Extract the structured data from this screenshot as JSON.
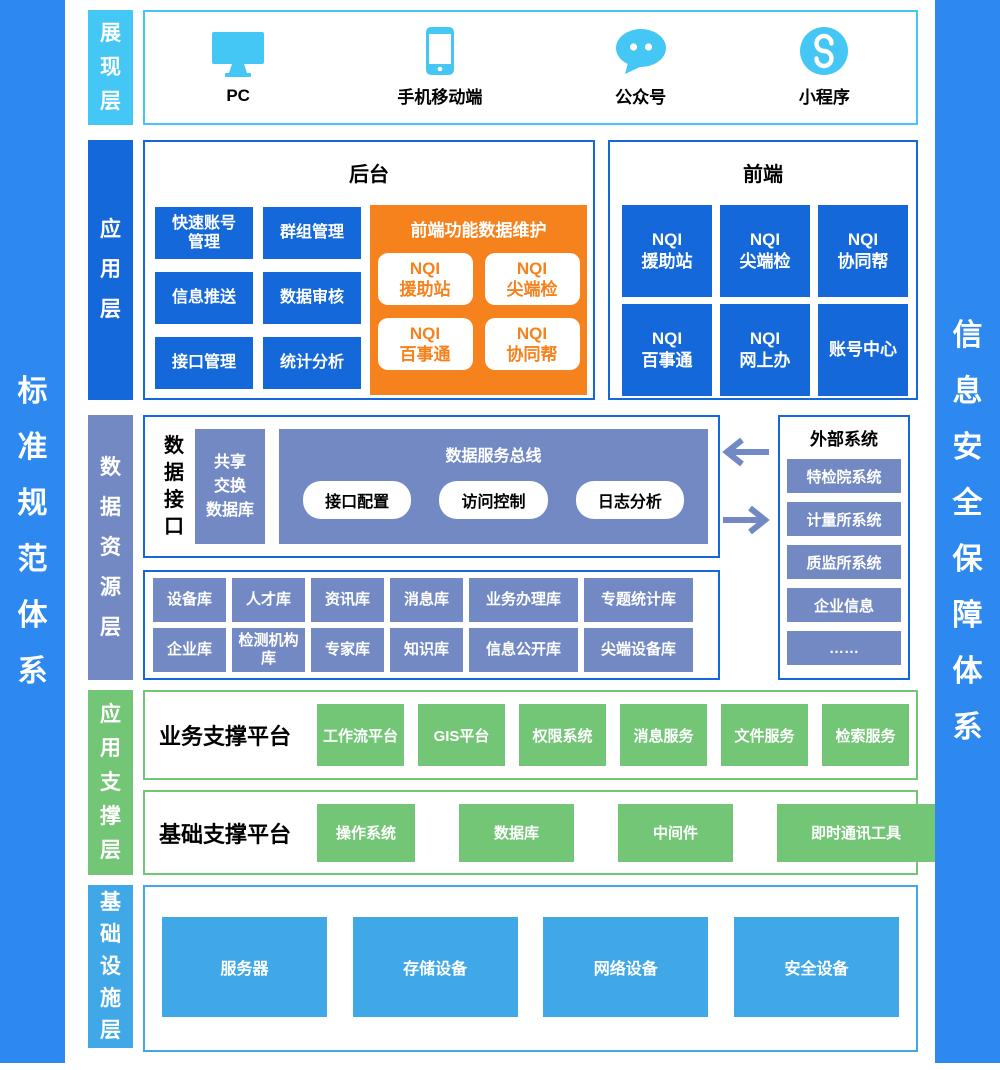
{
  "banners": {
    "left": "标准规范体系",
    "right": "信息安全保障体系"
  },
  "colors": {
    "banner_blue": "#2d89f0",
    "presentation_cyan": "#44c7f4",
    "application_blue": "#1568d9",
    "maintenance_orange": "#f6821e",
    "data_periwinkle": "#7289c4",
    "support_green": "#74c677",
    "infrastructure_blue": "#41a8e8"
  },
  "presentation": {
    "label": "展现层",
    "items": [
      {
        "label": "PC",
        "icon": "monitor-icon"
      },
      {
        "label": "手机移动端",
        "icon": "smartphone-icon"
      },
      {
        "label": "公众号",
        "icon": "chat-bubble-icon"
      },
      {
        "label": "小程序",
        "icon": "miniprogram-icon"
      }
    ]
  },
  "application": {
    "label": "应用层",
    "backend": {
      "title": "后台",
      "buttons": [
        "快速账号管理",
        "群组管理",
        "信息推送",
        "数据审核",
        "接口管理",
        "统计分析"
      ],
      "maintenance": {
        "title": "前端功能数据维护",
        "items": [
          "NQI\n援助站",
          "NQI\n尖端检",
          "NQI\n百事通",
          "NQI\n协同帮"
        ]
      }
    },
    "frontend": {
      "title": "前端",
      "items": [
        "NQI\n援助站",
        "NQI\n尖端检",
        "NQI\n协同帮",
        "NQI\n百事通",
        "NQI\n网上办",
        "账号中心"
      ]
    }
  },
  "data_layer": {
    "label": "数据资源层",
    "interface_label": "数据接口",
    "share_db": "共享\n交换\n数据库",
    "service_bus": {
      "title": "数据服务总线",
      "pills": [
        "接口配置",
        "访问控制",
        "日志分析"
      ]
    },
    "external": {
      "title": "外部系统",
      "items": [
        "特检院系统",
        "计量所系统",
        "质监所系统",
        "企业信息",
        "……"
      ]
    },
    "databases": {
      "row1": [
        "设备库",
        "人才库",
        "资讯库",
        "消息库",
        "业务办理库",
        "专题统计库"
      ],
      "row2": [
        "企业库",
        "检测机构库",
        "专家库",
        "知识库",
        "信息公开库",
        "尖端设备库"
      ]
    }
  },
  "support_layer": {
    "label": "应用支撑层",
    "business": {
      "title": "业务支撑平台",
      "items": [
        "工作流平台",
        "GIS平台",
        "权限系统",
        "消息服务",
        "文件服务",
        "检索服务"
      ]
    },
    "basic": {
      "title": "基础支撑平台",
      "items": [
        "操作系统",
        "数据库",
        "中间件",
        "即时通讯工具"
      ]
    }
  },
  "infrastructure": {
    "label": "基础设施层",
    "items": [
      "服务器",
      "存储设备",
      "网络设备",
      "安全设备"
    ]
  }
}
